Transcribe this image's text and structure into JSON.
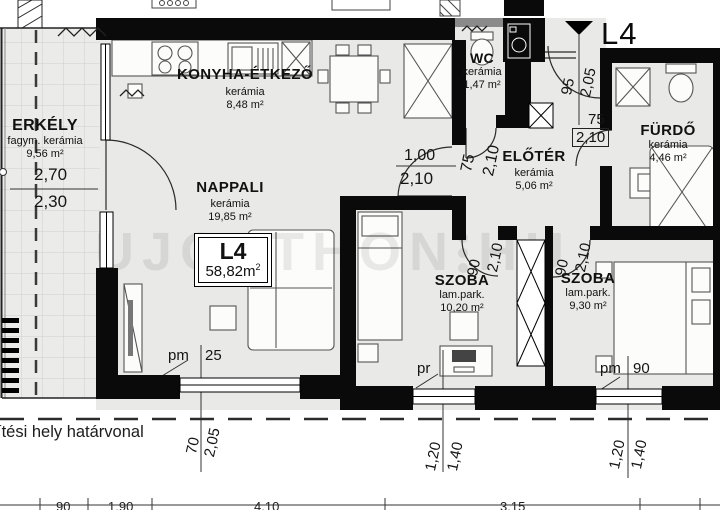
{
  "unit": {
    "code": "L4",
    "area_value": "58,82m",
    "area_sup": "2",
    "entry_marker": "L4"
  },
  "rooms": [
    {
      "id": "erkely",
      "name": "ERKÉLY",
      "material": "fagym. kerámia",
      "area": "9,56 m²"
    },
    {
      "id": "konyha",
      "name": "KONYHA-ÉTKEZŐ",
      "material": "kerámia",
      "area": "8,48 m²"
    },
    {
      "id": "nappali",
      "name": "NAPPALI",
      "material": "kerámia",
      "area": "19,85 m²"
    },
    {
      "id": "wc",
      "name": "WC",
      "material": "kerámia",
      "area": "1,47 m²"
    },
    {
      "id": "eloter",
      "name": "ELŐTÉR",
      "material": "kerámia",
      "area": "5,06 m²"
    },
    {
      "id": "furdo",
      "name": "FÜRDŐ",
      "material": "kerámia",
      "area": "4,46 m²"
    },
    {
      "id": "szoba1",
      "name": "SZOBA",
      "material": "lam.park.",
      "area": "10,20 m²"
    },
    {
      "id": "szoba2",
      "name": "SZOBA",
      "material": "lam.park.",
      "area": "9,30 m²"
    }
  ],
  "doors": {
    "entry": [
      "95",
      "2,05"
    ],
    "wc": [
      "75",
      "2,10"
    ],
    "nappali": [
      "1,00",
      "2,10"
    ],
    "furdo": [
      "75",
      "2,10"
    ],
    "szoba1": [
      "90",
      "2,10"
    ],
    "szoba2": [
      "90",
      "2,10"
    ]
  },
  "balcony_dims": [
    "2,70",
    "2,30"
  ],
  "windows": {
    "nappali_prefix": "pm",
    "nappali_value": "25",
    "szoba1_prefix": "pr",
    "szoba2_prefix": "pm",
    "szoba2_value": "90",
    "szoba1_dims": [
      "1,20",
      "1,40"
    ],
    "szoba2_dims": [
      "1,20",
      "1,40"
    ]
  },
  "site": {
    "bottom_left_dims": [
      "70",
      "2,05"
    ],
    "boundary_label": "ítési hely határvonal",
    "bottom_ticks": [
      "90",
      "1,90",
      "4,10",
      "3,15"
    ]
  },
  "watermark": {
    "left": "UJOTTHON",
    "right": "HU"
  },
  "colors": {
    "wall": "#0a0a0a",
    "floor": "#e9e9e7",
    "balcony_floor": "#ebebe9",
    "grid": "#cfcfcd",
    "outline": "#555555",
    "watermark": "rgba(0,0,0,0.08)"
  }
}
